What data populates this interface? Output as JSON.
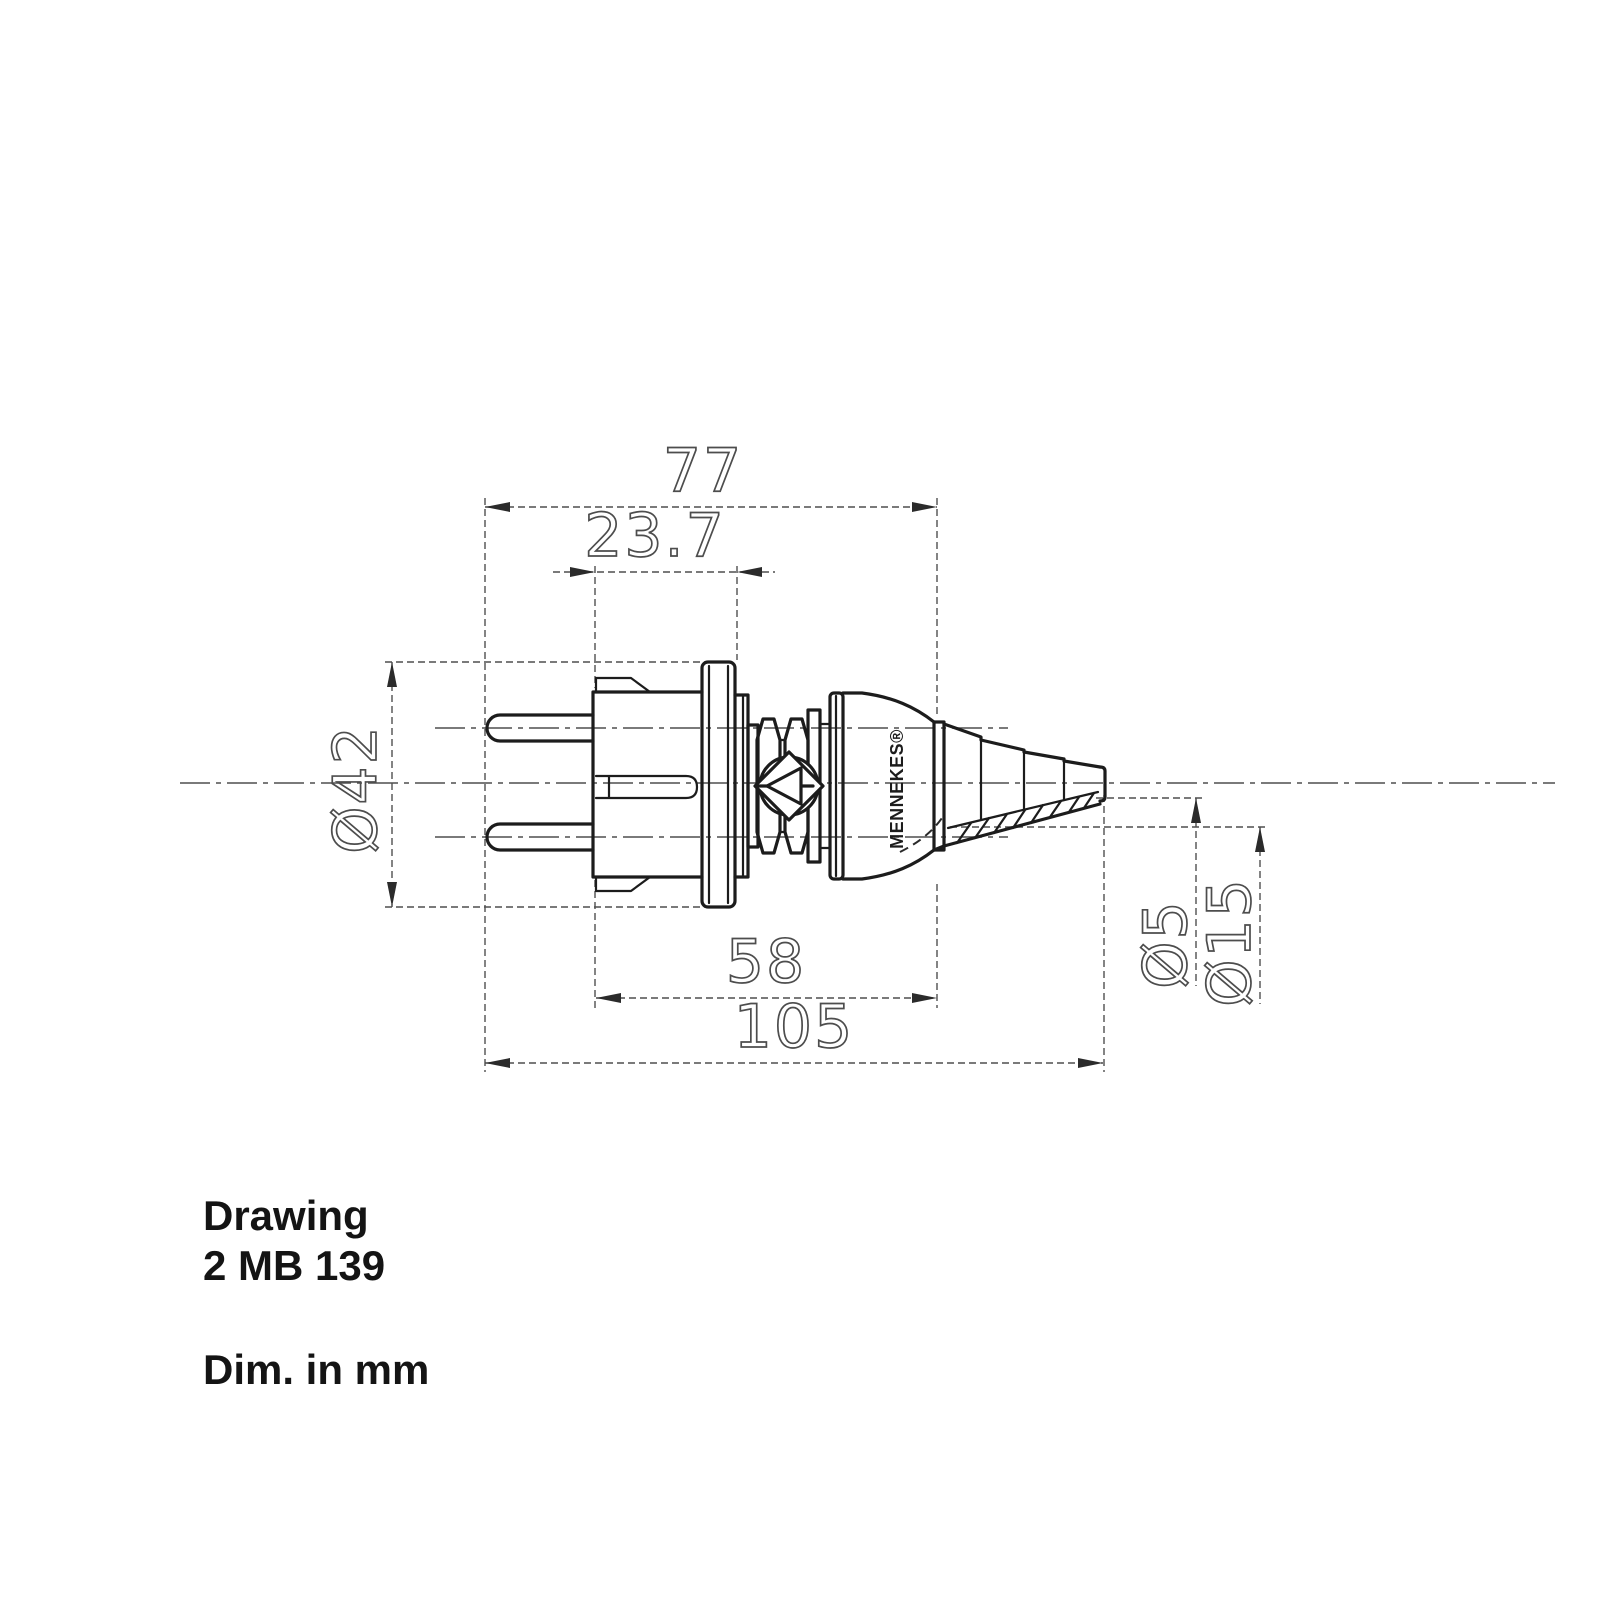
{
  "titleblock": {
    "title": "Drawing",
    "number": "2 MB 139",
    "units": "Dim. in mm"
  },
  "brand": {
    "name": "MENNEKES®"
  },
  "labels": {
    "overall_length": "105",
    "body_length": "58",
    "pins_to_bell": "77",
    "face_to_flange": "23.7",
    "flange_diameter": "Ø42",
    "cable_hole_diameter": "Ø5",
    "outlet_diameter": "Ø15"
  },
  "colors": {
    "outline": "#1c1c1c",
    "thin_line": "#4f4f4f",
    "dim_text": "#4d4d4d",
    "title_text": "#141414",
    "background": "#ffffff"
  }
}
